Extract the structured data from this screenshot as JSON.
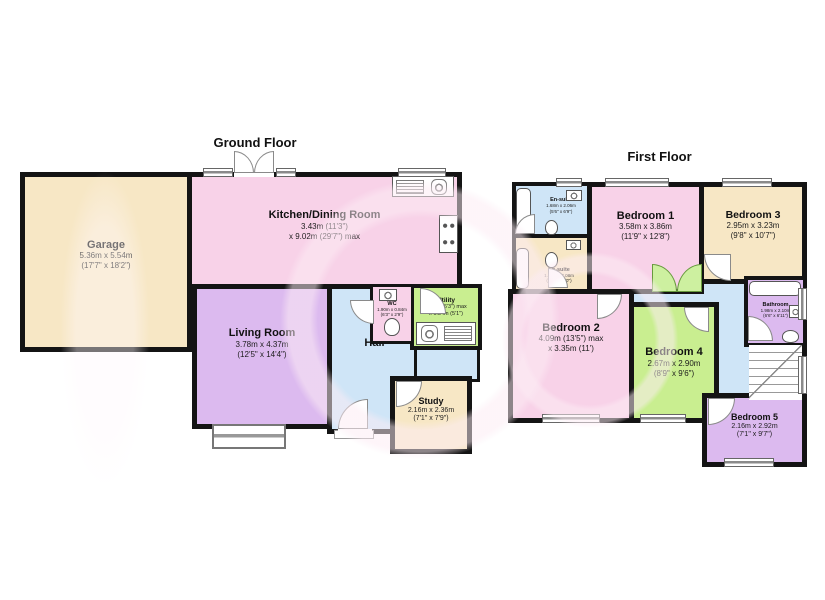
{
  "palette": {
    "wall": "#141414",
    "pink": "#f8d2e8",
    "cream": "#f7e7c5",
    "purple": "#dcbaef",
    "blue": "#cfe5f7",
    "green": "#c9ee90",
    "white": "#ffffff",
    "watermark": "#fcecf4",
    "plant": "#cdf0a0"
  },
  "icons": {
    "bath-icon": "rounded-rect-tub",
    "toilet-icon": "ellipse-pan",
    "sink-icon": "basin-with-circle",
    "hob-icon": "four-burner-rings",
    "kitchen-sink-icon": "basin-and-drainer",
    "stairs-icon": "steps-with-diagonal",
    "plant-icon": "green-fan-leaves",
    "door-icon": "quarter-circle-swing",
    "window-icon": "double-line-sill"
  },
  "ground": {
    "title": "Ground Floor",
    "garage": {
      "name": "Garage",
      "m": "5.36m x 5.54m",
      "ft": "(17'7\" x 18'2\")"
    },
    "kitchen": {
      "name": "Kitchen/Dining Room",
      "m": "3.43m (11'3\")",
      "ft": "x 9.02m (29'7\") max"
    },
    "living": {
      "name": "Living Room",
      "m": "3.78m x 4.37m",
      "ft": "(12'5\" x 14'4\")"
    },
    "hall": {
      "name": "Hall"
    },
    "wc": {
      "name": "WC",
      "m": "1.90m x 0.84m",
      "ft": "(6'3\" x 2'9\")"
    },
    "utility": {
      "name": "Utility",
      "m": "1.90m (6'3\") max",
      "ft": "x 1.54m (5'1\")"
    },
    "study": {
      "name": "Study",
      "m": "2.16m x 2.36m",
      "ft": "(7'1\" x 7'9\")"
    }
  },
  "first": {
    "title": "First Floor",
    "ensuite1": {
      "name": "En-suite",
      "m": "1.68m x 2.06m",
      "ft": "(5'6\" x 6'9\")"
    },
    "ensuite2": {
      "name": "En-suite",
      "m": "1.34m x 2.08m",
      "ft": "(4'5\" x 6'10\")"
    },
    "bed1": {
      "name": "Bedroom 1",
      "m": "3.58m x 3.86m",
      "ft": "(11'9\" x 12'8\")"
    },
    "bed3": {
      "name": "Bedroom 3",
      "m": "2.95m x 3.23m",
      "ft": "(9'8\" x 10'7\")"
    },
    "bed2": {
      "name": "Bedroom 2",
      "m": "4.09m (13'5\") max",
      "ft": "x 3.35m (11')"
    },
    "bed4": {
      "name": "Bedroom 4",
      "m": "2.67m x 2.90m",
      "ft": "(8'9\" x 9'6\")"
    },
    "bath": {
      "name": "Bathroom",
      "m": "1.98m x 2.10m",
      "ft": "(6'6\" x 6'11\")"
    },
    "bed5": {
      "name": "Bedroom 5",
      "m": "2.16m x 2.92m",
      "ft": "(7'1\" x 9'7\")"
    }
  }
}
